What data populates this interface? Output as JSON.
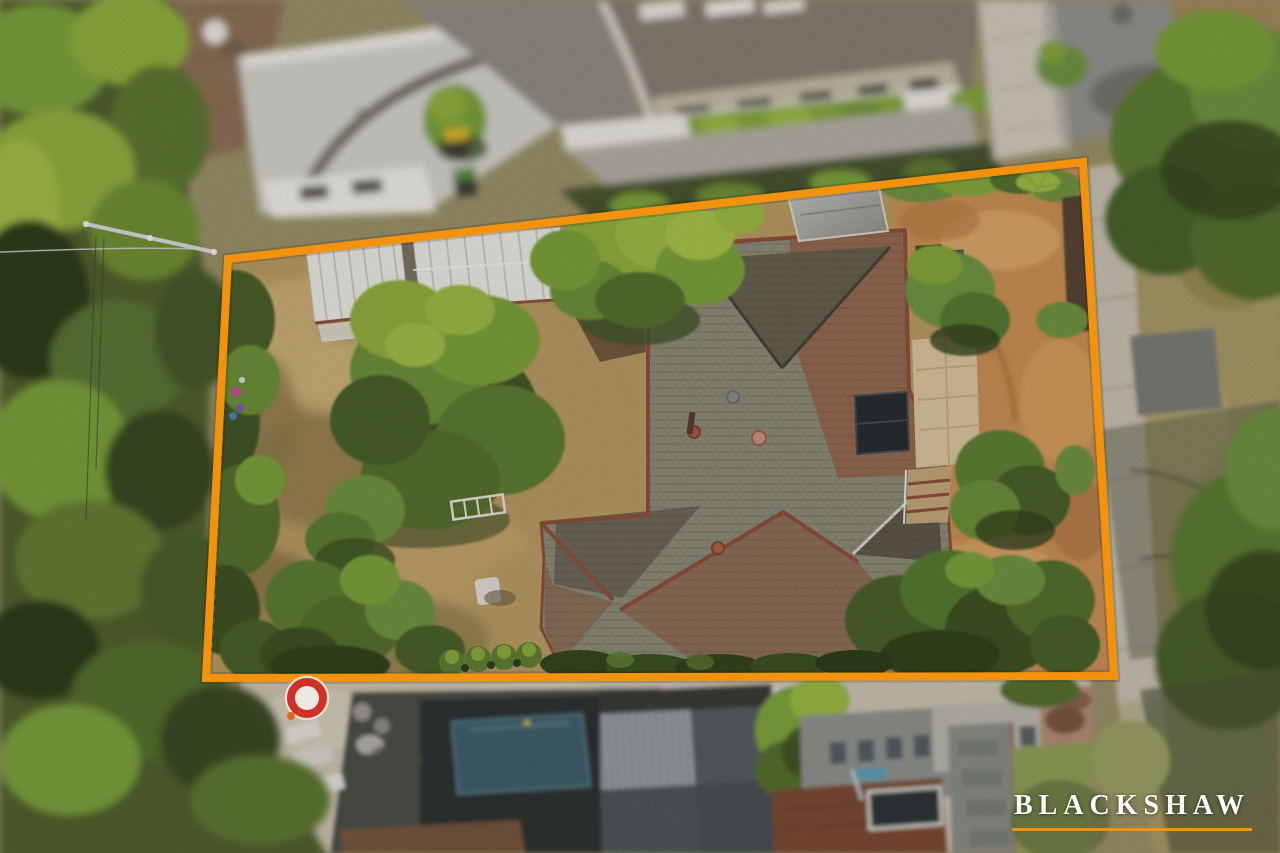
{
  "brand": {
    "name": "BLACKSHAW",
    "text_color": "#ffffff",
    "underline_color": "#f2920d"
  },
  "overlay": {
    "boundary_color": "#f2920d",
    "boundary_points": "228,259 1083,162 1114,676 206,678",
    "boundary_stroke_width": "8"
  },
  "palette": {
    "dry_lawn": "#b89a63",
    "lawn_light": "#c9ad76",
    "lawn_dark": "#97814f",
    "courtyard_gravel": "#c98f55",
    "house_roof_grey": "#8d8b78",
    "house_roof_dark": "#67614f",
    "house_roof_red": "#96684f",
    "ridge_cap": "#8e4f3b",
    "shed_roof": "#e9e7e0",
    "pool_water": "#41606c",
    "road_asphalt": "#94938e",
    "footpath_concrete": "#c6c0b0",
    "tree_bright": "#9aba45",
    "tree_mid": "#6f9340",
    "tree_dark": "#3c5222",
    "marker_ring": "#cf3127"
  }
}
